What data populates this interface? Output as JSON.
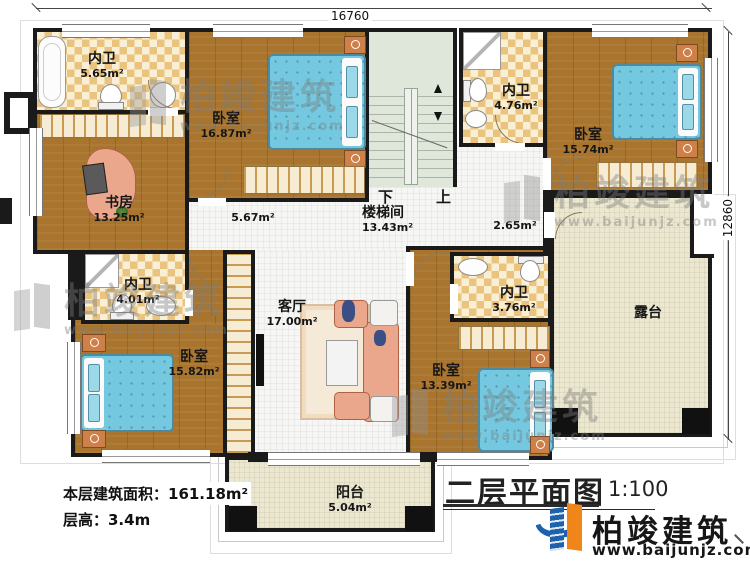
{
  "dimensions": {
    "top": "16760",
    "right": "12860"
  },
  "rooms": {
    "bath_top_left": {
      "name": "内卫",
      "area": "5.65m²"
    },
    "study": {
      "name": "书房",
      "area": "13.25m²"
    },
    "bedroom_top": {
      "name": "卧室",
      "area": "16.87m²"
    },
    "bath_top_right": {
      "name": "内卫",
      "area": "4.76m²"
    },
    "bedroom_right": {
      "name": "卧室",
      "area": "15.74m²"
    },
    "stair_hall": {
      "name": "楼梯间",
      "area": "13.43m²"
    },
    "hallway_left": {
      "area": "5.67m²"
    },
    "hallway_right": {
      "area": "2.65m²"
    },
    "bath_mid_left": {
      "name": "内卫",
      "area": "4.01m²"
    },
    "bedroom_bottom_left": {
      "name": "卧室",
      "area": "15.82m²"
    },
    "living_room": {
      "name": "客厅",
      "area": "17.00m²"
    },
    "bath_bottom_right": {
      "name": "内卫",
      "area": "3.76m²"
    },
    "bedroom_bottom_right": {
      "name": "卧室",
      "area": "13.39m²"
    },
    "terrace": {
      "name": "露台"
    },
    "balcony": {
      "name": "阳台",
      "area": "5.04m²"
    }
  },
  "stairs": {
    "down_label": "下",
    "up_label": "上"
  },
  "info": {
    "floor_area": "本层建筑面积：161.18m²",
    "floor_height": "层高：3.4m"
  },
  "title": {
    "text": "二层平面图",
    "scale": "1:100"
  },
  "brand": {
    "name": "柏竣建筑",
    "url": "www.baijunjz.com"
  },
  "watermark": {
    "name": "柏竣建筑",
    "url": "www.baijunjz.com"
  },
  "colors": {
    "wall": "#1a1a1a",
    "wood": "#a9752e",
    "tile": "#eac47f",
    "bed": "#74c8df",
    "sofa": "#eaa78c",
    "stair": "#dfe6da",
    "terrace": "#ece7cf",
    "logo_blue": "#1e62ae",
    "logo_orange": "#f08519"
  }
}
